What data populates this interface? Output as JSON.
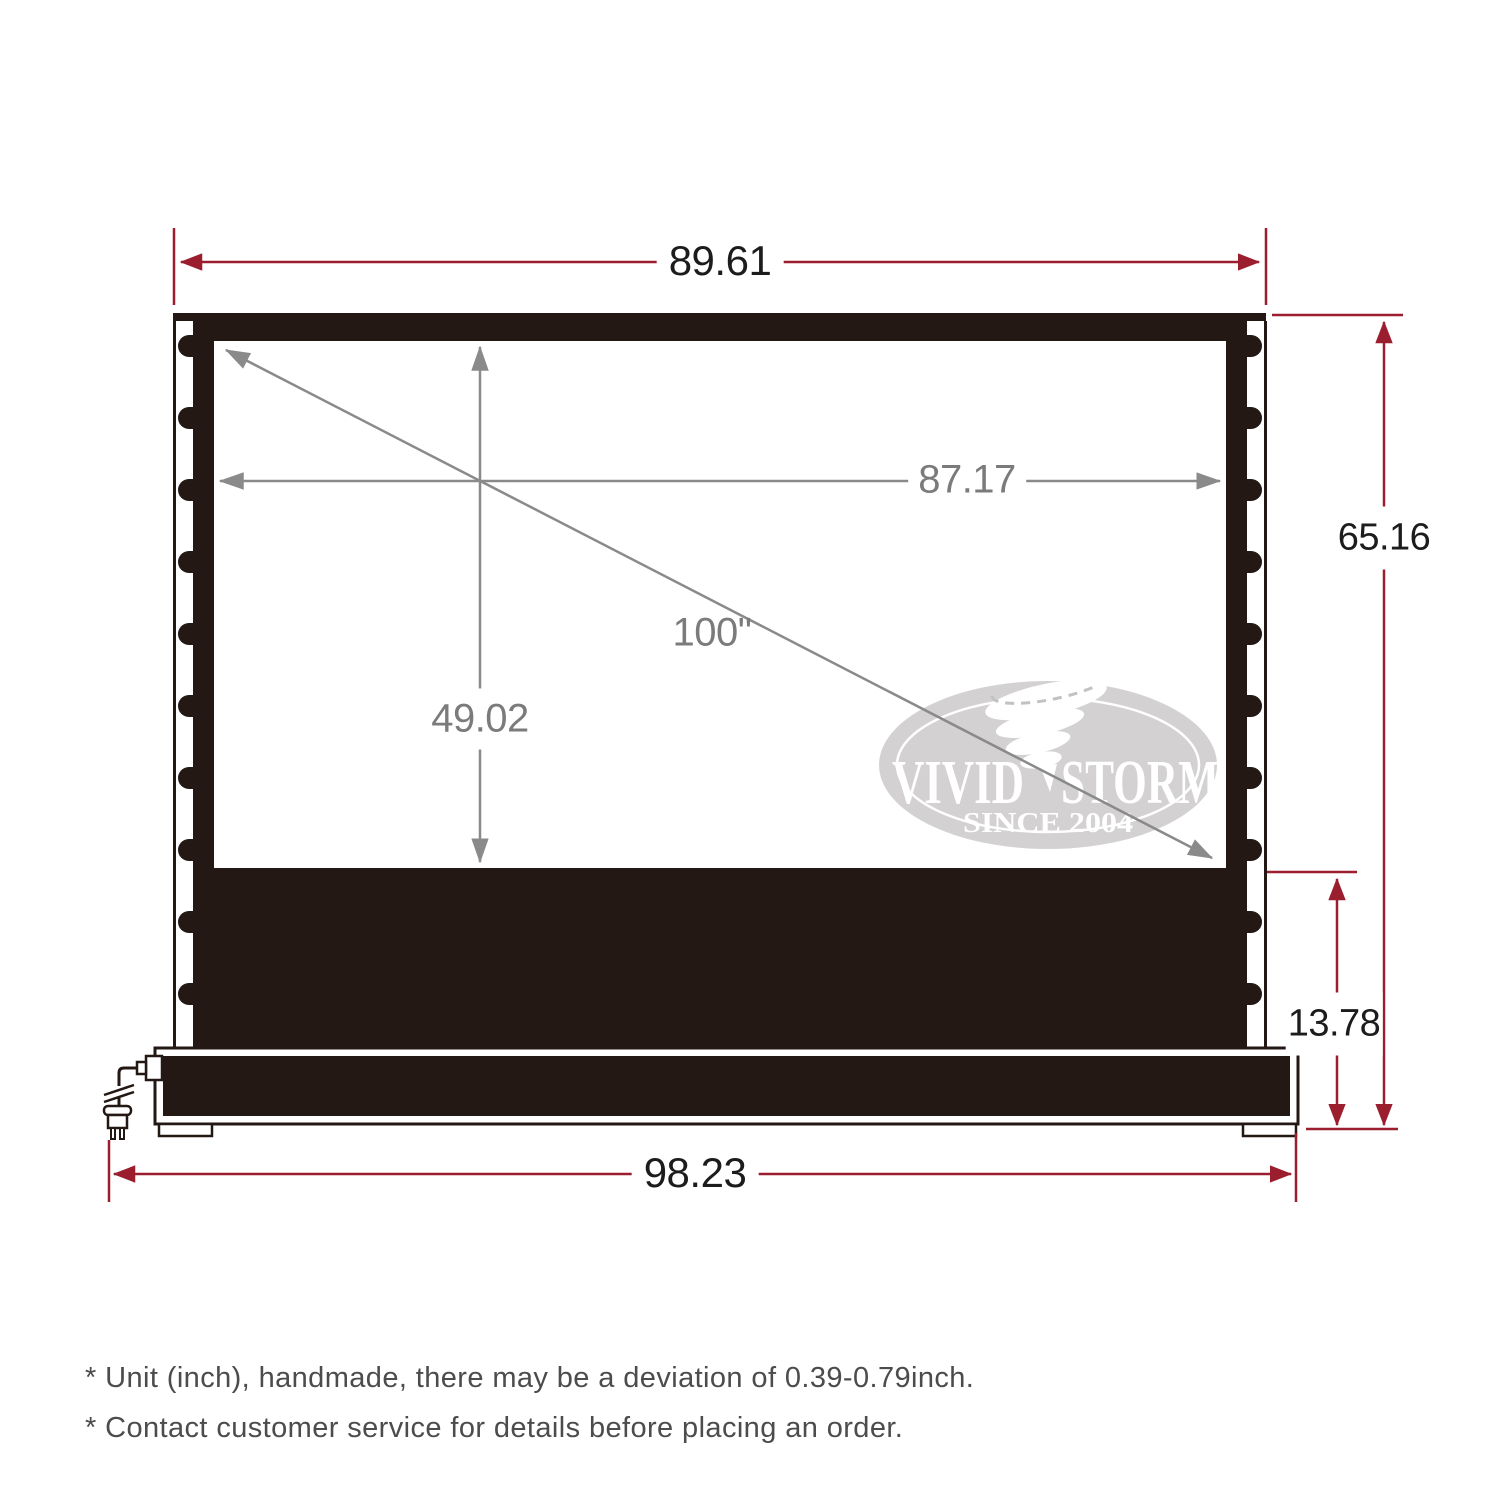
{
  "diagram": {
    "title_note": "projection screen dimension diagram",
    "dimensions": {
      "top_width": "89.61",
      "viewing_width": "87.17",
      "diagonal": "100\"",
      "viewing_height": "49.02",
      "total_height": "65.16",
      "base_height": "13.78",
      "base_width": "98.23"
    },
    "logo": {
      "brand_left": "VIVID",
      "brand_right": "STORM",
      "tagline": "SINCE 2004"
    },
    "footnotes": [
      "* Unit (inch), handmade, there may be a deviation of 0.39-0.79inch.",
      "* Contact customer service for details before placing an order."
    ],
    "colors": {
      "dimension_red": "#9b1e2e",
      "arrow_gray": "#8a8a8a",
      "housing_dark": "#231813",
      "logo_gray": "#d3d1d1"
    }
  }
}
